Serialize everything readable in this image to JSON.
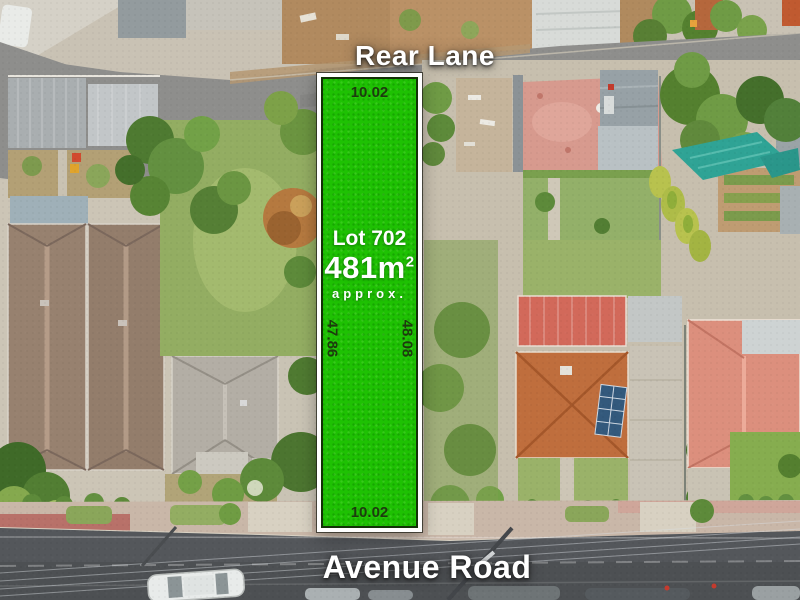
{
  "labels": {
    "top_road": "Rear Lane",
    "bottom_road": "Avenue Road"
  },
  "lot": {
    "name": "Lot 702",
    "area_value": "481m",
    "area_sup": "2",
    "qualifier": "approx.",
    "dim_top": "10.02",
    "dim_bottom": "10.02",
    "dim_left": "47.86",
    "dim_right": "48.08"
  },
  "colors": {
    "lot_green": "#1EC103",
    "lot_frame": "#FFFFFF",
    "dim_text": "#1D3A0E",
    "road_label_text": "#FFFFFF"
  }
}
